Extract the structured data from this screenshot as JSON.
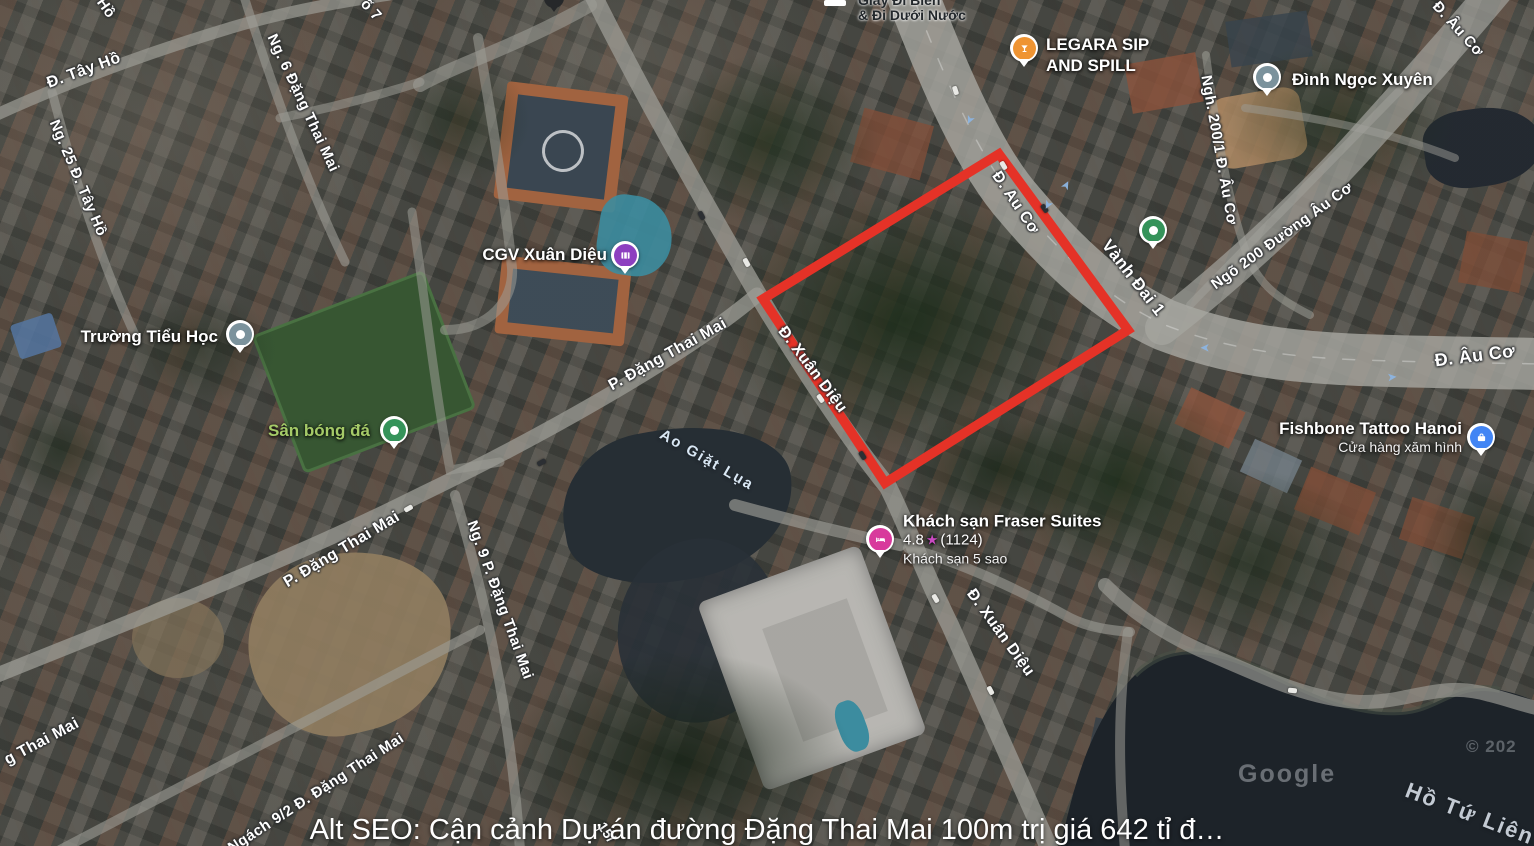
{
  "map": {
    "caption": "Alt SEO: Cận cảnh Dự án đường Đặng Thai Mai 100m trị giá 642 tỉ đ…",
    "highlight_color": "#e53227",
    "road_labels": [
      "Đ. Tây Hồ",
      "Hồ",
      "ố 7",
      "Ng. 25 Đ. Tây Hồ",
      "Ng. 6 Đặng Thai Mai",
      "P. Đặng Thai Mai",
      "P. Đặng Thai Mai",
      "Ng. 9 P. Đặng Thai Mai",
      "Ngách 9/2 Đ. Đặng Thai Mai",
      "g Thai Mai",
      "Đ. Xuân Diệu",
      "Đ. Xuân Diệu",
      "Đ. Au Cơ",
      "Vành Đai 1",
      "Đ. Âu Cơ",
      "Đ. Âu Cơ",
      "Ngõ 200 Đường Âu Cơ",
      "Ngh. 200/1 Đ. Âu Cơ",
      "15/"
    ],
    "water_labels": [
      "Ao Giặt Lụa",
      "Hồ Tứ Liên"
    ],
    "pois": {
      "cgv": {
        "name": "CGV Xuân Diệu",
        "color": "#8d3fc0"
      },
      "legara": {
        "line1": "LEGARA SIP",
        "line2": "AND SPILL",
        "color": "#ef9432"
      },
      "dinh": {
        "name": "Đình Ngọc Xuyên",
        "color": "#7b929c"
      },
      "school": {
        "name": "Trường Tiểu Học",
        "color": "#7b929c"
      },
      "field": {
        "name": "Sân bóng đá",
        "color": "#35935a",
        "text_color": "#a5cb68"
      },
      "fraser": {
        "name": "Khách sạn Fraser Suites",
        "rating": "4.8",
        "reviews": "(1124)",
        "subtitle": "Khách sạn 5 sao",
        "color": "#d83a9c"
      },
      "fishbone": {
        "name": "Fishbone Tattoo Hanoi",
        "subtitle": "Cửa hàng xăm hình",
        "color": "#4285f4"
      },
      "shoe_shop": {
        "line1": "Giày Đi Biển",
        "line2": "& Đi Dưới Nước"
      }
    },
    "icons": {
      "star": "★",
      "lane_arrow": "➤"
    },
    "watermark": {
      "google": "Google",
      "copyright": "© 202"
    }
  }
}
